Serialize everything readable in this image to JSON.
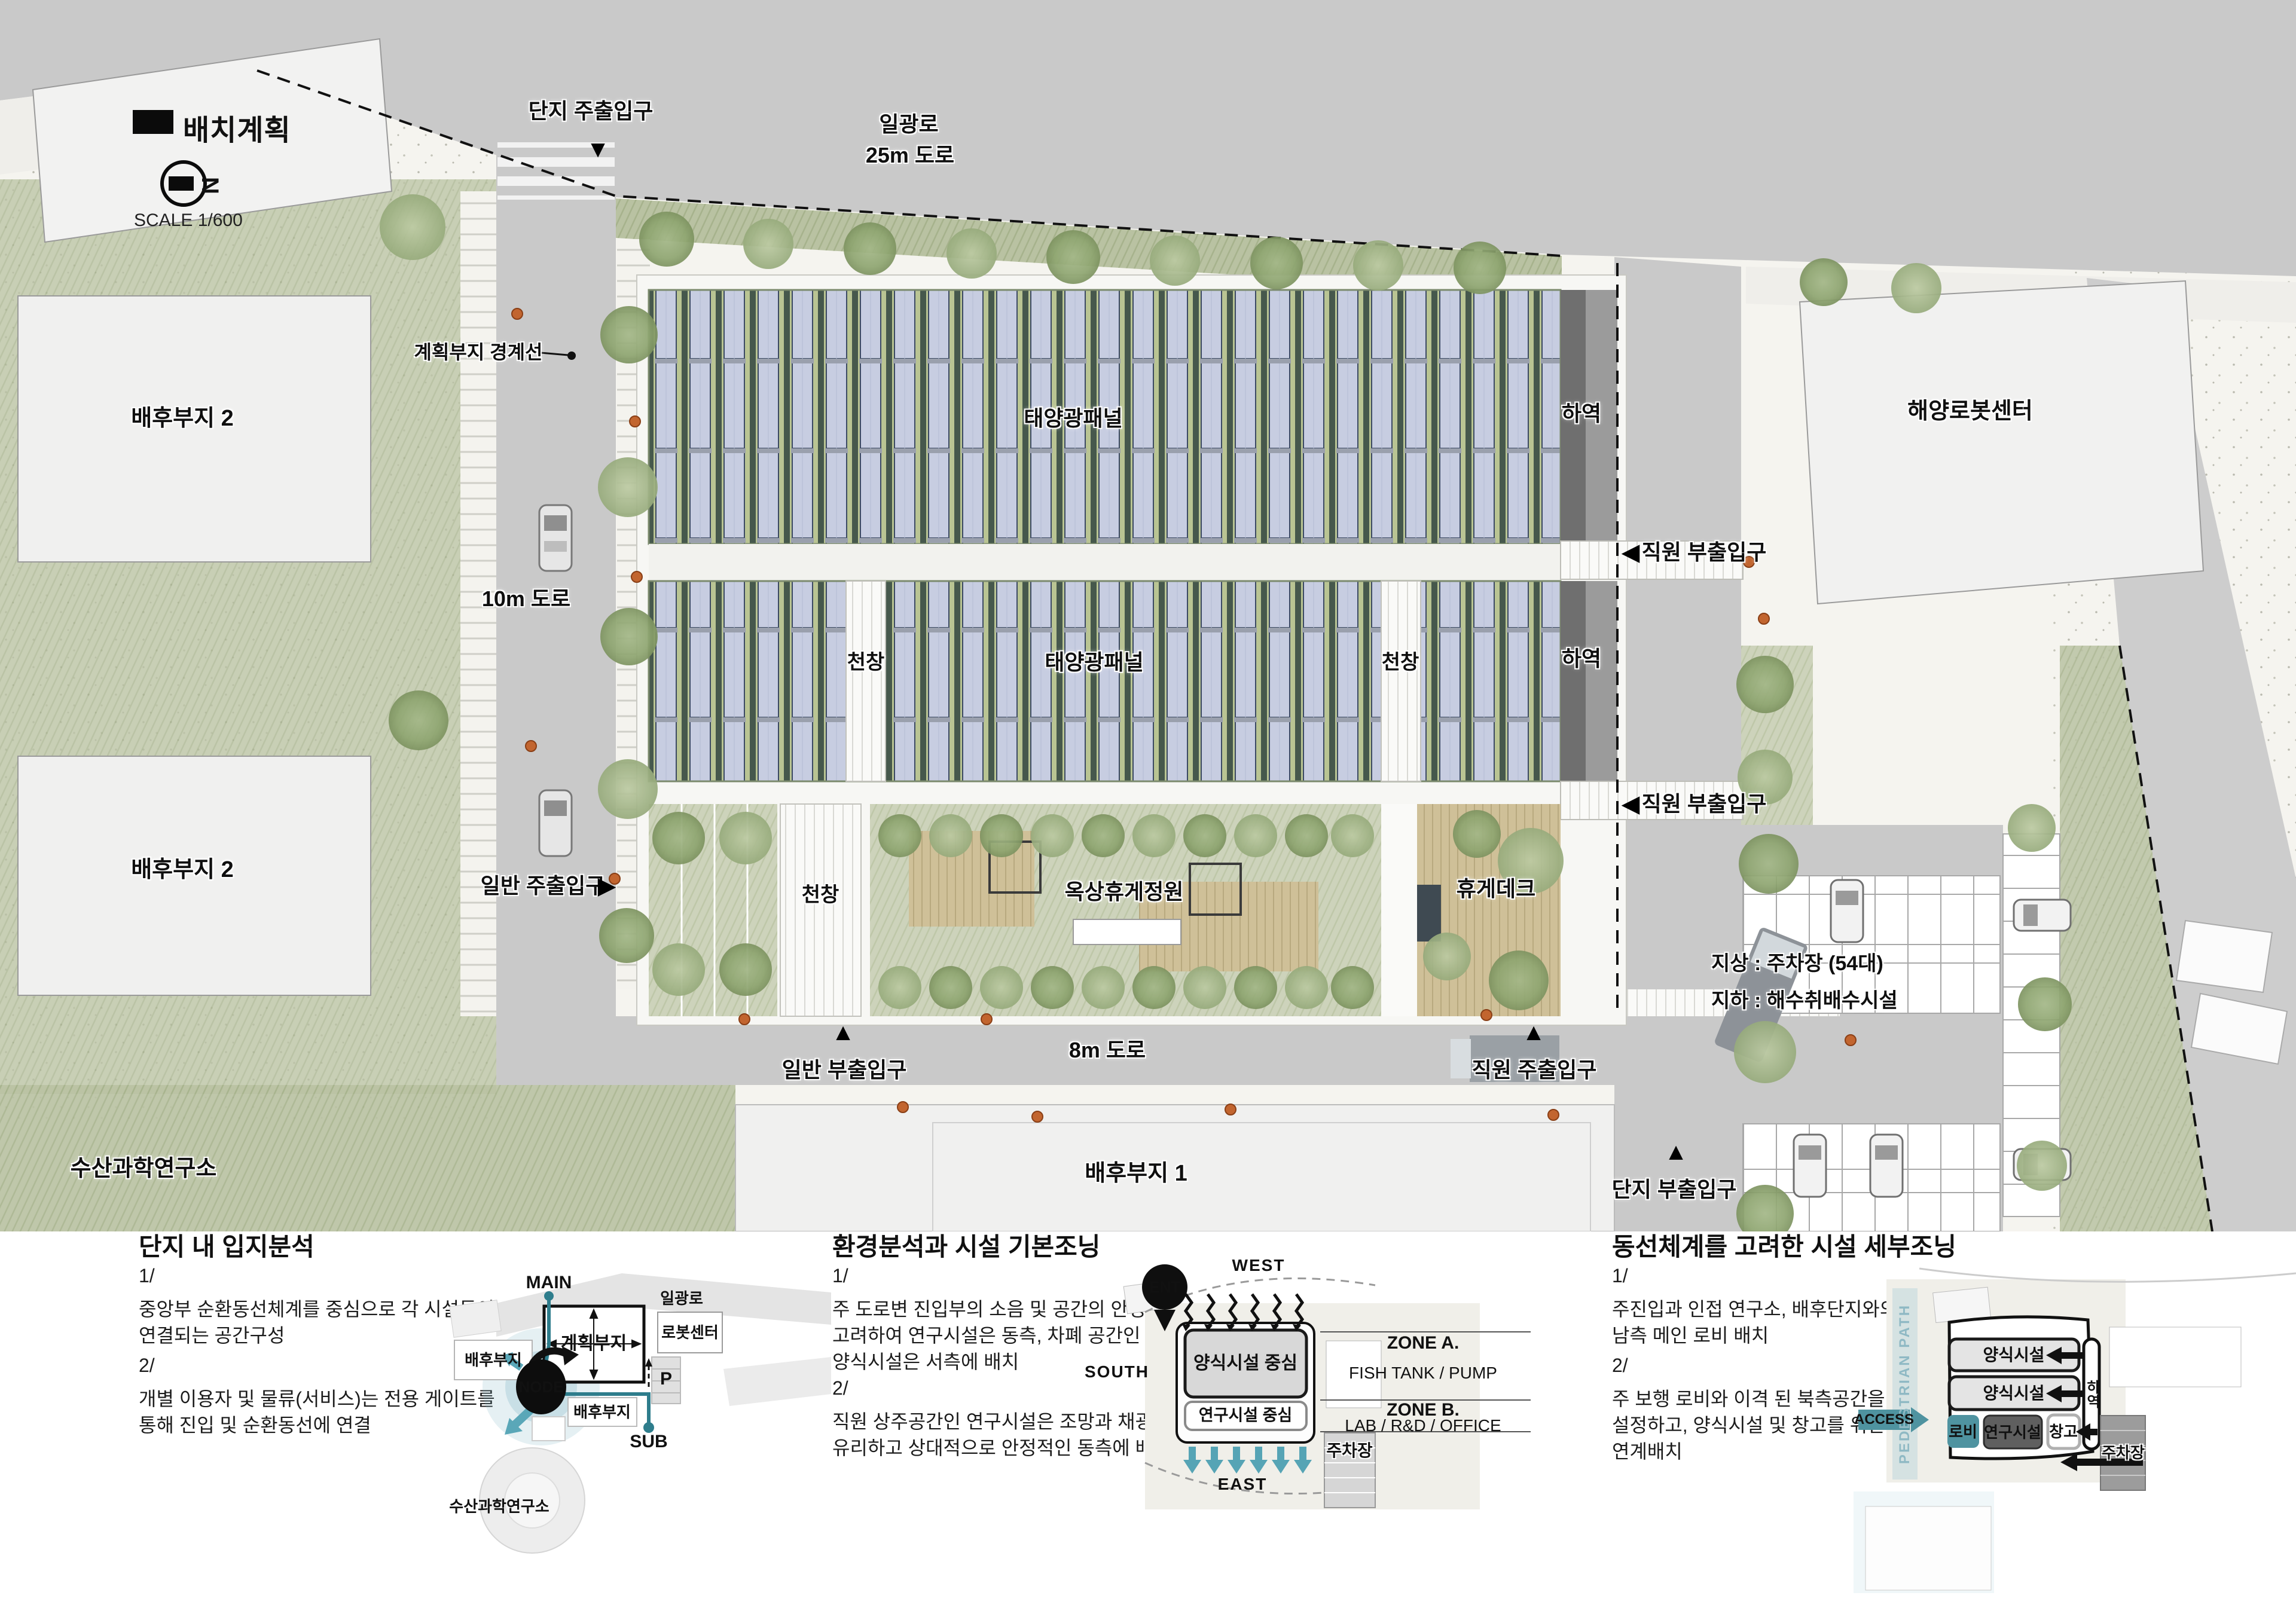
{
  "legend": {
    "title": "배치계획",
    "scale": "SCALE 1/600",
    "north_letter": "N"
  },
  "icons": {
    "down_triangle": "▼",
    "up_triangle": "▲",
    "left_triangle": "◀",
    "right_triangle": "▶"
  },
  "plan": {
    "roads": {
      "main_road_name": "일광로",
      "main_road_size": "25m 도로",
      "west_road": "10m 도로",
      "south_road": "8m 도로"
    },
    "boundary_label": "계획부지 경계선",
    "context": {
      "rear_site_2_upper": "배후부지 2",
      "rear_site_2_lower": "배후부지 2",
      "rear_site_1": "배후부지 1",
      "robot_center": "해양로봇센터",
      "fisheries_institute": "수산과학연구소"
    },
    "building": {
      "solar_band1": "태양광패널",
      "solar_band2": "태양광패널",
      "skylight_band2_left": "천창",
      "skylight_band2_right": "천창",
      "skylight_band3": "천창",
      "roof_garden": "옥상휴게정원",
      "rest_deck": "휴게데크",
      "loading_upper": "하역",
      "loading_lower": "하역"
    },
    "parking": {
      "line1": "지상 : 주차장 (54대)",
      "line2": "지하 : 해수취배수시설"
    },
    "entrances": {
      "complex_main": "단지 주출입구",
      "staff_sub_upper": "직원 부출입구",
      "staff_sub_lower": "직원 부출입구",
      "public_main": "일반 주출입구",
      "public_sub": "일반 부출입구",
      "staff_main": "직원 주출입구",
      "complex_sub": "단지 부출입구"
    }
  },
  "panels": [
    {
      "title": "단지 내 입지분석",
      "items": [
        {
          "no": "1/",
          "text": "중앙부 순환동선체계를 중심으로 각 시설들이 연결되는 공간구성"
        },
        {
          "no": "2/",
          "text": "개별 이용자 및 물류(서비스)는 전용 게이트를 통해 진입 및 순환동선에 연결"
        }
      ],
      "diagram": {
        "main": "MAIN",
        "sub": "SUB",
        "node": "NODE",
        "parking": "P",
        "road": "일광로",
        "plan_site": "계획부지",
        "robot": "로봇센터",
        "rear_upper": "배후부지",
        "rear_lower": "배후부지",
        "fisheries": "수산과학연구소"
      }
    },
    {
      "title": "환경분석과 시설 기본조닝",
      "items": [
        {
          "no": "1/",
          "text": "주 도로변 진입부의 소음 및 공간의 안정도를 고려하여 연구시설은 동측, 차폐 공간인 양식시설은 서측에 배치"
        },
        {
          "no": "2/",
          "text": "직원 상주공간인 연구시설은 조망과 채광에 유리하고 상대적으로 안정적인 동측에 배치"
        }
      ],
      "diagram": {
        "west": "WEST",
        "south": "SOUTH",
        "east": "EAST",
        "ent": "ENT",
        "farm": "양식시설 중심",
        "research": "연구시설 중심",
        "zone_a": "ZONE A.",
        "zone_a_desc": "FISH TANK / PUMP",
        "zone_b": "ZONE B.",
        "zone_b_desc": "LAB / R&D / OFFICE",
        "parking": "주차장"
      }
    },
    {
      "title": "동선체계를 고려한 시설 세부조닝",
      "items": [
        {
          "no": "1/",
          "text": "주진입과 인접 연구소, 배후단지와의 관계를 고려한 남측 메인 로비 배치"
        },
        {
          "no": "2/",
          "text": "주 보행 로비와 이격 된 북측공간을 서비스 영역으로 설정하고, 양식시설 및 창고를 위한 하역/서비스 공간 연계배치"
        }
      ],
      "diagram": {
        "pedestrian_path": "PEDESTRIAN PATH",
        "access": "ACCESS",
        "farm1": "양식시설",
        "farm2": "양식시설",
        "lobby": "로비",
        "research": "연구시설",
        "storage": "창고",
        "loading": "하역",
        "parking": "주차장"
      }
    }
  ],
  "colors": {
    "accent_teal": "#2e7d8c",
    "panel_lavender": "#c7cde1",
    "grass_green": "#b7c09c",
    "road_gray": "#c9c9c9",
    "deck_wood": "#cfc098"
  }
}
